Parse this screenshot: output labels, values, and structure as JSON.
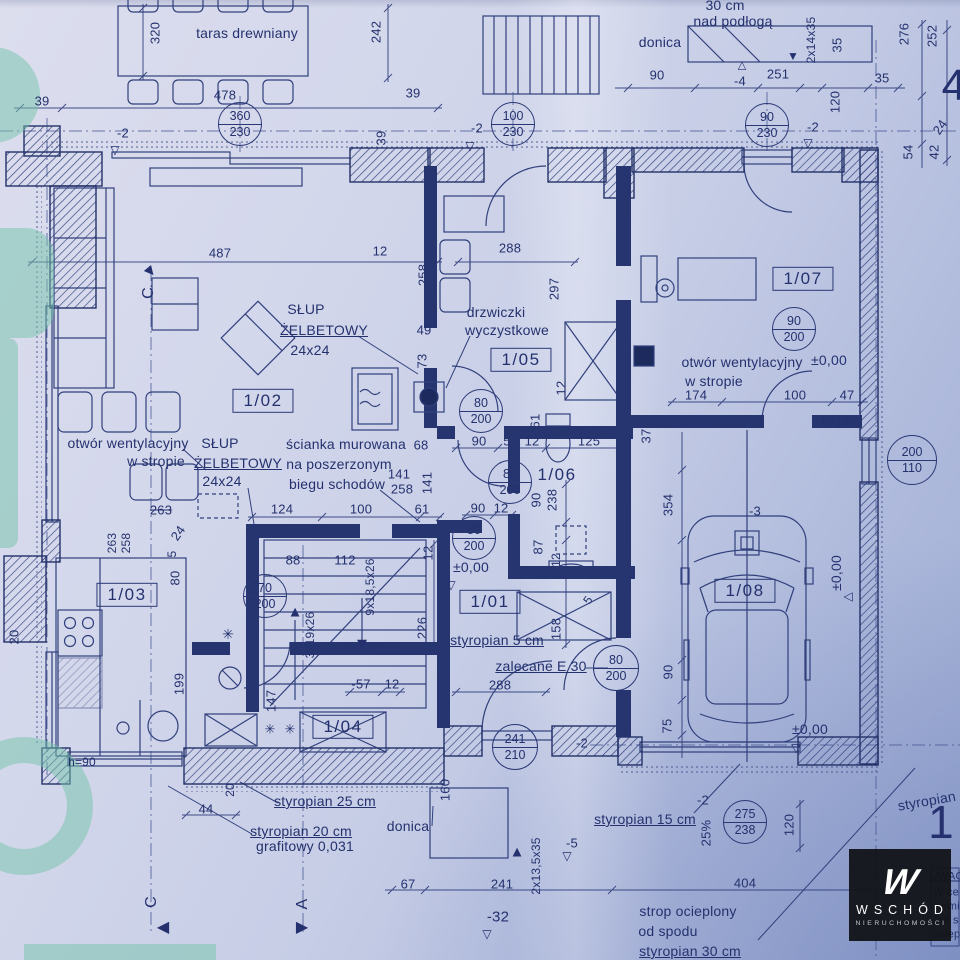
{
  "colors": {
    "ink": "#2b3a78",
    "paper": "#ccd3e8",
    "green": "#74c3a9",
    "watermark_bg": "#111217"
  },
  "watermark": {
    "monogram": "W",
    "brand": "WSCHÓD",
    "subtitle": "NIERUCHOMOŚCI"
  },
  "rooms": [
    {
      "label": "1/01",
      "x": 490,
      "y": 602,
      "boxed": true
    },
    {
      "label": "1/02",
      "x": 263,
      "y": 401,
      "boxed": true
    },
    {
      "label": "1/03",
      "x": 127,
      "y": 595,
      "boxed": true
    },
    {
      "label": "1/04",
      "x": 343,
      "y": 727,
      "boxed": true
    },
    {
      "label": "1/05",
      "x": 521,
      "y": 360,
      "boxed": true
    },
    {
      "label": "1/06",
      "x": 557,
      "y": 475,
      "boxed": false
    },
    {
      "label": "1/07",
      "x": 803,
      "y": 279,
      "boxed": true
    },
    {
      "label": "1/08",
      "x": 745,
      "y": 591,
      "boxed": true
    }
  ],
  "door_circles": [
    {
      "top": "360",
      "bottom": "230",
      "x": 240,
      "y": 124,
      "r": 21
    },
    {
      "top": "100",
      "bottom": "230",
      "x": 513,
      "y": 124,
      "r": 21
    },
    {
      "top": "90",
      "bottom": "230",
      "x": 767,
      "y": 125,
      "r": 21
    },
    {
      "top": "90",
      "bottom": "200",
      "x": 794,
      "y": 329,
      "r": 21
    },
    {
      "top": "80",
      "bottom": "200",
      "x": 481,
      "y": 411,
      "r": 21
    },
    {
      "top": "80",
      "bottom": "200",
      "x": 510,
      "y": 482,
      "r": 21
    },
    {
      "top": "80",
      "bottom": "200",
      "x": 474,
      "y": 538,
      "r": 21
    },
    {
      "top": "80",
      "bottom": "200",
      "x": 616,
      "y": 668,
      "r": 22
    },
    {
      "top": "70",
      "bottom": "200",
      "x": 265,
      "y": 596,
      "r": 21
    },
    {
      "top": "241",
      "bottom": "210",
      "x": 515,
      "y": 747,
      "r": 22
    },
    {
      "top": "275",
      "bottom": "238",
      "x": 745,
      "y": 822,
      "r": 21
    },
    {
      "top": "200",
      "bottom": "110",
      "x": 912,
      "y": 460,
      "r": 24
    }
  ],
  "labels": [
    {
      "t": "320",
      "x": 155,
      "y": 33,
      "rot": -90
    },
    {
      "t": "taras drewniany",
      "x": 247,
      "y": 33,
      "fs": 14,
      "n": "area-label"
    },
    {
      "t": "242",
      "x": 376,
      "y": 32,
      "rot": -90
    },
    {
      "t": "30 cm",
      "x": 725,
      "y": 5,
      "fs": 14,
      "n": "note-label"
    },
    {
      "t": "nad podłogą",
      "x": 733,
      "y": 21,
      "fs": 14,
      "n": "note-label"
    },
    {
      "t": "donica",
      "x": 660,
      "y": 42,
      "fs": 14,
      "n": "area-label"
    },
    {
      "t": "2x14x35",
      "x": 811,
      "y": 40,
      "rot": -90,
      "fs": 12
    },
    {
      "t": "35",
      "x": 837,
      "y": 45,
      "rot": -90
    },
    {
      "t": "276",
      "x": 904,
      "y": 34,
      "rot": -90
    },
    {
      "t": "252",
      "x": 932,
      "y": 36,
      "rot": -90
    },
    {
      "t": "4",
      "x": 954,
      "y": 86,
      "fs": 44,
      "n": "sheet-number"
    },
    {
      "t": "90",
      "x": 657,
      "y": 75
    },
    {
      "t": "-4",
      "x": 740,
      "y": 81
    },
    {
      "t": "251",
      "x": 778,
      "y": 74
    },
    {
      "t": "35",
      "x": 882,
      "y": 78
    },
    {
      "t": "478",
      "x": 225,
      "y": 95
    },
    {
      "t": "39",
      "x": 42,
      "y": 101
    },
    {
      "t": "39",
      "x": 413,
      "y": 93
    },
    {
      "t": "120",
      "x": 835,
      "y": 102,
      "rot": -90
    },
    {
      "t": "-2",
      "x": 123,
      "y": 133
    },
    {
      "t": "-2",
      "x": 477,
      "y": 128
    },
    {
      "t": "-2",
      "x": 813,
      "y": 127
    },
    {
      "t": "39",
      "x": 381,
      "y": 138,
      "rot": -90
    },
    {
      "t": "24",
      "x": 940,
      "y": 127,
      "rot": -55
    },
    {
      "t": "42",
      "x": 934,
      "y": 152,
      "rot": -90
    },
    {
      "t": "54",
      "x": 908,
      "y": 152,
      "rot": -90
    },
    {
      "t": "487",
      "x": 220,
      "y": 253
    },
    {
      "t": "12",
      "x": 380,
      "y": 251
    },
    {
      "t": "288",
      "x": 510,
      "y": 248
    },
    {
      "t": "258",
      "x": 423,
      "y": 275,
      "rot": -90
    },
    {
      "t": "297",
      "x": 554,
      "y": 289,
      "rot": -90
    },
    {
      "t": "C",
      "x": 149,
      "y": 293,
      "rot": -90,
      "fs": 16,
      "n": "section-letter"
    },
    {
      "t": "SŁUP",
      "x": 306,
      "y": 309,
      "fs": 14,
      "n": "note-label"
    },
    {
      "t": "drzwiczki",
      "x": 496,
      "y": 312,
      "fs": 14,
      "n": "note-label"
    },
    {
      "t": "ŻELBETOWY",
      "x": 324,
      "y": 330,
      "fs": 14,
      "u": 1,
      "n": "note-label"
    },
    {
      "t": "wyczystkowe",
      "x": 507,
      "y": 330,
      "fs": 14,
      "n": "note-label"
    },
    {
      "t": "49",
      "x": 424,
      "y": 330
    },
    {
      "t": "24x24",
      "x": 310,
      "y": 350,
      "fs": 14,
      "n": "note-label"
    },
    {
      "t": "73",
      "x": 422,
      "y": 361,
      "rot": -90
    },
    {
      "t": "12",
      "x": 561,
      "y": 388,
      "rot": -90
    },
    {
      "t": "otwór wentylacyjny",
      "x": 742,
      "y": 362,
      "fs": 14,
      "n": "note-label"
    },
    {
      "t": "±0,00",
      "x": 829,
      "y": 360,
      "fs": 14,
      "n": "level-label"
    },
    {
      "t": "w stropie",
      "x": 714,
      "y": 381,
      "fs": 14,
      "n": "note-label"
    },
    {
      "t": "174",
      "x": 696,
      "y": 395
    },
    {
      "t": "100",
      "x": 795,
      "y": 395
    },
    {
      "t": "47",
      "x": 847,
      "y": 395
    },
    {
      "t": "h=100",
      "x": 839,
      "y": 421,
      "fs": 12,
      "n": "note-label"
    },
    {
      "t": "37",
      "x": 646,
      "y": 436,
      "rot": -90
    },
    {
      "t": "otwór wentylacyjny",
      "x": 128,
      "y": 443,
      "fs": 14,
      "n": "note-label"
    },
    {
      "t": "w stropie",
      "x": 156,
      "y": 461,
      "fs": 14,
      "n": "note-label"
    },
    {
      "t": "SŁUP",
      "x": 220,
      "y": 443,
      "fs": 14,
      "n": "note-label"
    },
    {
      "t": "ŻELBETOWY",
      "x": 238,
      "y": 463,
      "fs": 14,
      "u": 1,
      "n": "note-label"
    },
    {
      "t": "24x24",
      "x": 222,
      "y": 481,
      "fs": 14,
      "n": "note-label"
    },
    {
      "t": "ścianka murowana",
      "x": 346,
      "y": 444,
      "fs": 14,
      "n": "note-label"
    },
    {
      "t": "na poszerzonym",
      "x": 339,
      "y": 464,
      "fs": 14,
      "n": "note-label"
    },
    {
      "t": "biegu schodów",
      "x": 337,
      "y": 484,
      "fs": 14,
      "n": "note-label"
    },
    {
      "t": "68",
      "x": 421,
      "y": 445
    },
    {
      "t": "90",
      "x": 479,
      "y": 441
    },
    {
      "t": "5",
      "x": 507,
      "y": 441
    },
    {
      "t": "12",
      "x": 532,
      "y": 441
    },
    {
      "t": "125",
      "x": 589,
      "y": 441
    },
    {
      "t": "61",
      "x": 535,
      "y": 421,
      "rot": -90
    },
    {
      "t": "141",
      "x": 399,
      "y": 474
    },
    {
      "t": "258",
      "x": 402,
      "y": 489
    },
    {
      "t": "141",
      "x": 427,
      "y": 483,
      "rot": -90
    },
    {
      "t": "124",
      "x": 282,
      "y": 509
    },
    {
      "t": "100",
      "x": 361,
      "y": 509
    },
    {
      "t": "61",
      "x": 422,
      "y": 509
    },
    {
      "t": "263",
      "x": 161,
      "y": 510,
      "s": 1
    },
    {
      "t": "90",
      "x": 478,
      "y": 508
    },
    {
      "t": "12",
      "x": 501,
      "y": 508
    },
    {
      "t": "90",
      "x": 536,
      "y": 500,
      "rot": -90
    },
    {
      "t": "238",
      "x": 552,
      "y": 500,
      "rot": -90
    },
    {
      "t": "354",
      "x": 668,
      "y": 505,
      "rot": -90
    },
    {
      "t": "-3",
      "x": 755,
      "y": 511
    },
    {
      "t": "263",
      "x": 112,
      "y": 543,
      "rot": -90,
      "fs": 12
    },
    {
      "t": "258",
      "x": 126,
      "y": 543,
      "rot": -90,
      "fs": 12
    },
    {
      "t": "24",
      "x": 178,
      "y": 533,
      "rot": -55
    },
    {
      "t": "5",
      "x": 172,
      "y": 554,
      "rot": -90,
      "fs": 12
    },
    {
      "t": "80",
      "x": 175,
      "y": 578,
      "rot": -90
    },
    {
      "t": "88",
      "x": 293,
      "y": 560
    },
    {
      "t": "112",
      "x": 345,
      "y": 560
    },
    {
      "t": "9x18,5x26",
      "x": 370,
      "y": 587,
      "rot": -90,
      "fs": 12
    },
    {
      "t": "12",
      "x": 428,
      "y": 553,
      "rot": -90
    },
    {
      "t": "87",
      "x": 538,
      "y": 547,
      "rot": -90
    },
    {
      "t": "12",
      "x": 556,
      "y": 560,
      "rot": -90,
      "fs": 12
    },
    {
      "t": "±0,00",
      "x": 471,
      "y": 567,
      "fs": 14,
      "n": "level-label"
    },
    {
      "t": "±0,00",
      "x": 836,
      "y": 573,
      "rot": -90,
      "fs": 14,
      "n": "level-label"
    },
    {
      "t": "5",
      "x": 588,
      "y": 600,
      "rot": -55,
      "fs": 12
    },
    {
      "t": "3x19x26",
      "x": 310,
      "y": 635,
      "rot": -90,
      "fs": 12
    },
    {
      "t": "226",
      "x": 422,
      "y": 628,
      "rot": -90
    },
    {
      "t": "158",
      "x": 556,
      "y": 629,
      "rot": -90
    },
    {
      "t": "styropian 5  cm",
      "x": 497,
      "y": 640,
      "fs": 14,
      "u": 1,
      "n": "note-label"
    },
    {
      "t": "zalecane E 30",
      "x": 541,
      "y": 666,
      "fs": 14,
      "u": 1,
      "n": "note-label"
    },
    {
      "t": "20",
      "x": 14,
      "y": 637,
      "rot": -90
    },
    {
      "t": "199",
      "x": 179,
      "y": 684,
      "rot": -90
    },
    {
      "t": "-57",
      "x": 361,
      "y": 684
    },
    {
      "t": "12",
      "x": 392,
      "y": 684
    },
    {
      "t": "288",
      "x": 500,
      "y": 685
    },
    {
      "t": "90",
      "x": 668,
      "y": 672,
      "rot": -90
    },
    {
      "t": "147",
      "x": 271,
      "y": 701,
      "rot": -90
    },
    {
      "t": "75",
      "x": 667,
      "y": 726,
      "rot": -90
    },
    {
      "t": "±0,00",
      "x": 810,
      "y": 729,
      "fs": 14,
      "n": "level-label"
    },
    {
      "t": "-2",
      "x": 582,
      "y": 743
    },
    {
      "t": "h=90",
      "x": 82,
      "y": 762,
      "fs": 12,
      "n": "note-label"
    },
    {
      "t": "160",
      "x": 445,
      "y": 790,
      "rot": -90
    },
    {
      "t": "20",
      "x": 230,
      "y": 790,
      "rot": -90,
      "fs": 12
    },
    {
      "t": "-2",
      "x": 703,
      "y": 800
    },
    {
      "t": "44",
      "x": 206,
      "y": 809
    },
    {
      "t": "styropian 25 cm",
      "x": 325,
      "y": 801,
      "fs": 14,
      "u": 1,
      "n": "note-label"
    },
    {
      "t": "styropian 15 cm",
      "x": 645,
      "y": 819,
      "fs": 14,
      "u": 1,
      "n": "note-label"
    },
    {
      "t": "donica",
      "x": 408,
      "y": 826,
      "fs": 14,
      "n": "area-label"
    },
    {
      "t": "styropian 20 cm",
      "x": 301,
      "y": 831,
      "fs": 14,
      "u": 1,
      "n": "note-label"
    },
    {
      "t": "25%",
      "x": 706,
      "y": 833,
      "rot": -90
    },
    {
      "t": "120",
      "x": 789,
      "y": 825,
      "rot": -90
    },
    {
      "t": "grafitowy 0,031",
      "x": 305,
      "y": 846,
      "fs": 14,
      "n": "note-label"
    },
    {
      "t": "-5",
      "x": 572,
      "y": 843
    },
    {
      "t": "2x13,5x35",
      "x": 536,
      "y": 866,
      "rot": -90,
      "fs": 12
    },
    {
      "t": "styropian 25 cm",
      "x": 948,
      "y": 797,
      "rot": -10,
      "fs": 14,
      "n": "note-label"
    },
    {
      "t": "1",
      "x": 941,
      "y": 822,
      "fs": 46,
      "n": "sheet-number"
    },
    {
      "t": "67",
      "x": 408,
      "y": 884
    },
    {
      "t": "241",
      "x": 502,
      "y": 884
    },
    {
      "t": "404",
      "x": 745,
      "y": 883
    },
    {
      "t": "C",
      "x": 152,
      "y": 902,
      "rot": -90,
      "fs": 16,
      "n": "section-letter"
    },
    {
      "t": "A",
      "x": 303,
      "y": 904,
      "rot": -90,
      "fs": 16,
      "n": "section-letter"
    },
    {
      "t": "-32",
      "x": 498,
      "y": 917,
      "fs": 15
    },
    {
      "t": "strop ocieplony",
      "x": 688,
      "y": 911,
      "fs": 14,
      "n": "note-label"
    },
    {
      "t": "od spodu",
      "x": 668,
      "y": 931,
      "fs": 14,
      "n": "note-label"
    },
    {
      "t": "styropian 30 cm",
      "x": 690,
      "y": 951,
      "fs": 14,
      "u": 1,
      "n": "note-label"
    },
    {
      "t": "UWAG",
      "x": 947,
      "y": 877,
      "fs": 11,
      "u": 1,
      "n": "notes-fragment"
    },
    {
      "t": "W ce",
      "x": 946,
      "y": 893,
      "fs": 11,
      "n": "notes-fragment"
    },
    {
      "t": "termi",
      "x": 947,
      "y": 907,
      "fs": 11,
      "n": "notes-fragment"
    },
    {
      "t": "(od s",
      "x": 946,
      "y": 921,
      "fs": 11,
      "n": "notes-fragment"
    },
    {
      "t": "ociepl",
      "x": 948,
      "y": 935,
      "fs": 11,
      "n": "notes-fragment"
    }
  ],
  "markers": [
    {
      "g": "▽",
      "x": 115,
      "y": 150
    },
    {
      "g": "▽",
      "x": 470,
      "y": 146
    },
    {
      "g": "▽",
      "x": 808,
      "y": 143
    },
    {
      "g": "△",
      "x": 742,
      "y": 66,
      "fs": 11
    },
    {
      "g": "▼",
      "x": 793,
      "y": 56
    },
    {
      "g": "▽",
      "x": 451,
      "y": 585
    },
    {
      "g": "▽",
      "x": 849,
      "y": 597,
      "rot": 90
    },
    {
      "g": "▽",
      "x": 796,
      "y": 748
    },
    {
      "g": "▽",
      "x": 487,
      "y": 934
    },
    {
      "g": "▽",
      "x": 567,
      "y": 856
    },
    {
      "g": "▲",
      "x": 295,
      "y": 612,
      "fs": 15,
      "n": "stair-arrow-icon"
    },
    {
      "g": "▼",
      "x": 362,
      "y": 644,
      "fs": 17,
      "n": "stair-arrow-icon"
    },
    {
      "g": "▲",
      "x": 517,
      "y": 852,
      "fs": 15,
      "n": "stair-arrow-icon"
    },
    {
      "g": "▲",
      "x": 150,
      "y": 271,
      "rot": 140,
      "fs": 16,
      "n": "section-arrow-icon"
    },
    {
      "g": "◀",
      "x": 163,
      "y": 928,
      "fs": 16,
      "n": "section-arrow-icon"
    },
    {
      "g": "▶",
      "x": 302,
      "y": 928,
      "fs": 16,
      "n": "section-arrow-icon"
    },
    {
      "g": "✳",
      "x": 228,
      "y": 634,
      "fs": 14,
      "n": "appliance-symbol-icon"
    },
    {
      "g": "✳",
      "x": 270,
      "y": 729,
      "fs": 13,
      "n": "appliance-symbol-icon"
    },
    {
      "g": "✳",
      "x": 290,
      "y": 729,
      "fs": 13,
      "n": "appliance-symbol-icon"
    }
  ]
}
